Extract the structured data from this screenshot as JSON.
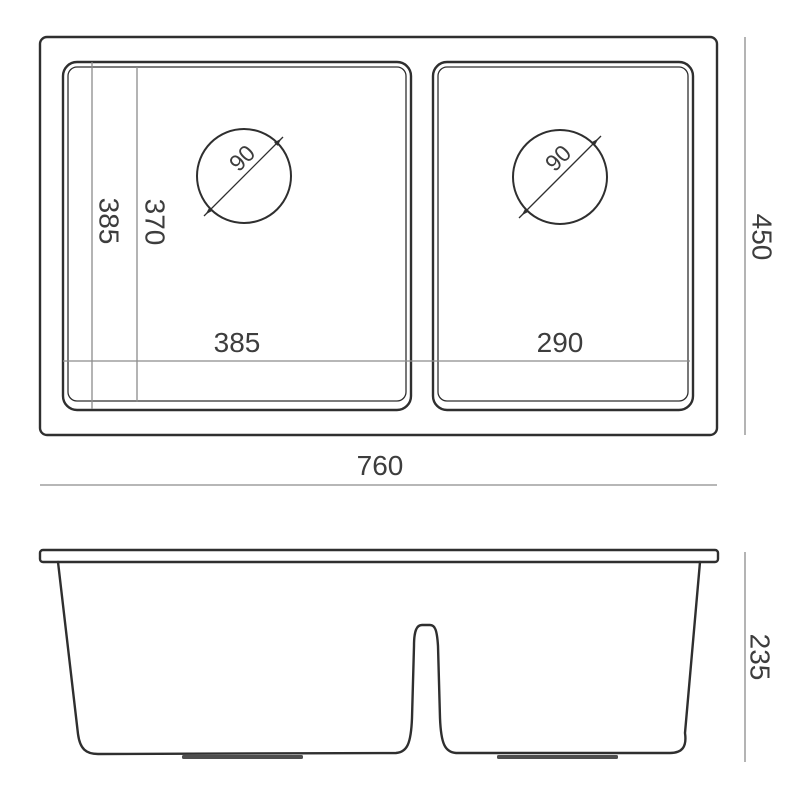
{
  "drawing": {
    "title": "double-bowl-sink-dimension-drawing",
    "top_view": {
      "overall_width_label": "760",
      "overall_depth_label": "450",
      "left_bowl_length_label": "385",
      "left_bowl_inner_length_label": "370",
      "left_bowl_width_label": "385",
      "right_bowl_width_label": "290",
      "left_drain_diameter_label": "90",
      "right_drain_diameter_label": "90"
    },
    "front_view": {
      "height_label": "235"
    },
    "colors": {
      "outline": "#2f2f2f",
      "dimension_line": "#8c8c8c",
      "text": "#3d3d3d",
      "background": "#ffffff"
    }
  }
}
